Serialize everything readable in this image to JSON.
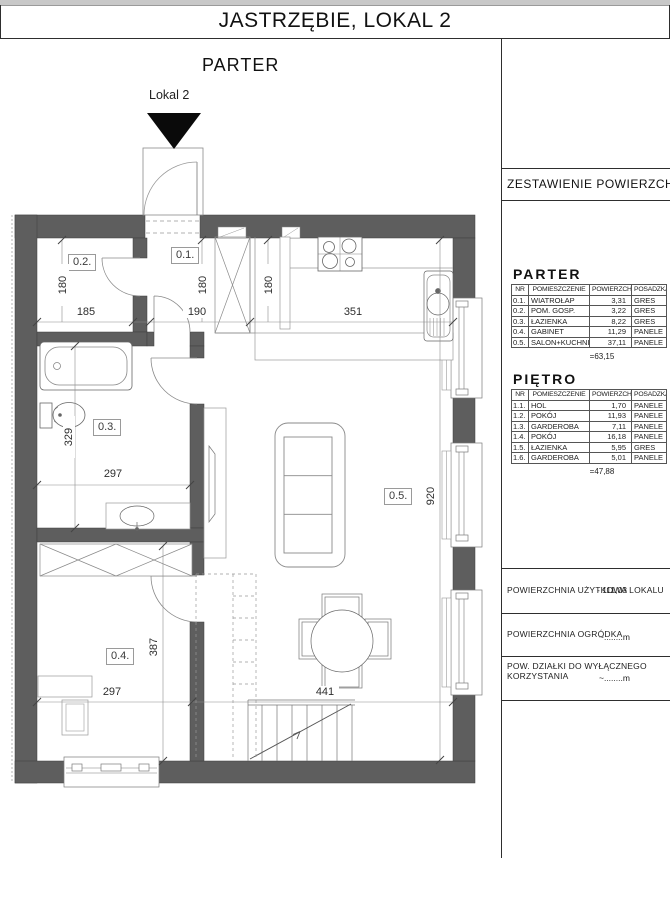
{
  "page": {
    "title": "JASTRZĘBIE, LOKAL 2",
    "floor_label": "PARTER",
    "entrance_label": "Lokal 2"
  },
  "area_table": {
    "title": "ZESTAWIENIE POWIERZCHNI",
    "columns": [
      "NR",
      "POMIESZCZENIE",
      "POWIERZCHNIA",
      "POSADZKA"
    ],
    "floors": [
      {
        "name": "PARTER",
        "total": "=63,15",
        "rows": [
          {
            "nr": "0.1.",
            "room": "WIATROŁAP",
            "area": "3,31",
            "finish": "GRES"
          },
          {
            "nr": "0.2.",
            "room": "POM. GOSP.",
            "area": "3,22",
            "finish": "GRES"
          },
          {
            "nr": "0.3.",
            "room": "ŁAZIENKA",
            "area": "8,22",
            "finish": "GRES"
          },
          {
            "nr": "0.4.",
            "room": "GABINET",
            "area": "11,29",
            "finish": "PANELE"
          },
          {
            "nr": "0.5.",
            "room": "SALON+KUCHNIA",
            "area": "37,11",
            "finish": "PANELE"
          }
        ]
      },
      {
        "name": "PIĘTRO",
        "total": "=47,88",
        "rows": [
          {
            "nr": "1.1.",
            "room": "HOL",
            "area": "1,70",
            "finish": "PANELE"
          },
          {
            "nr": "1.2.",
            "room": "POKÓJ",
            "area": "11,93",
            "finish": "PANELE"
          },
          {
            "nr": "1.3.",
            "room": "GARDEROBA",
            "area": "7,11",
            "finish": "PANELE"
          },
          {
            "nr": "1.4.",
            "room": "POKÓJ",
            "area": "16,18",
            "finish": "PANELE"
          },
          {
            "nr": "1.5.",
            "room": "ŁAZIENKA",
            "area": "5,95",
            "finish": "GRES"
          },
          {
            "nr": "1.6.",
            "room": "GARDEROBA",
            "area": "5,01",
            "finish": "PANELE"
          }
        ]
      }
    ],
    "summary": [
      {
        "label": "POWIERZCHNIA UŻYTKOWA LOKALU",
        "value": "- 111,03"
      },
      {
        "label": "POWIERZCHNIA OGRÓDKA",
        "value": "~........m"
      },
      {
        "label": "POW. DZIAŁKI DO WYŁĄCZNEGO",
        "label2": "KORZYSTANIA",
        "value": "~........m"
      }
    ]
  },
  "plan": {
    "room_labels": {
      "r01": "0.1.",
      "r02": "0.2.",
      "r03": "0.3.",
      "r04": "0.4.",
      "r05": "0.5."
    },
    "dims": {
      "d185": "185",
      "d190": "190",
      "d351": "351",
      "d180": "180",
      "d329": "329",
      "d297": "297",
      "d920": "920",
      "d387": "387",
      "d441": "441"
    }
  }
}
